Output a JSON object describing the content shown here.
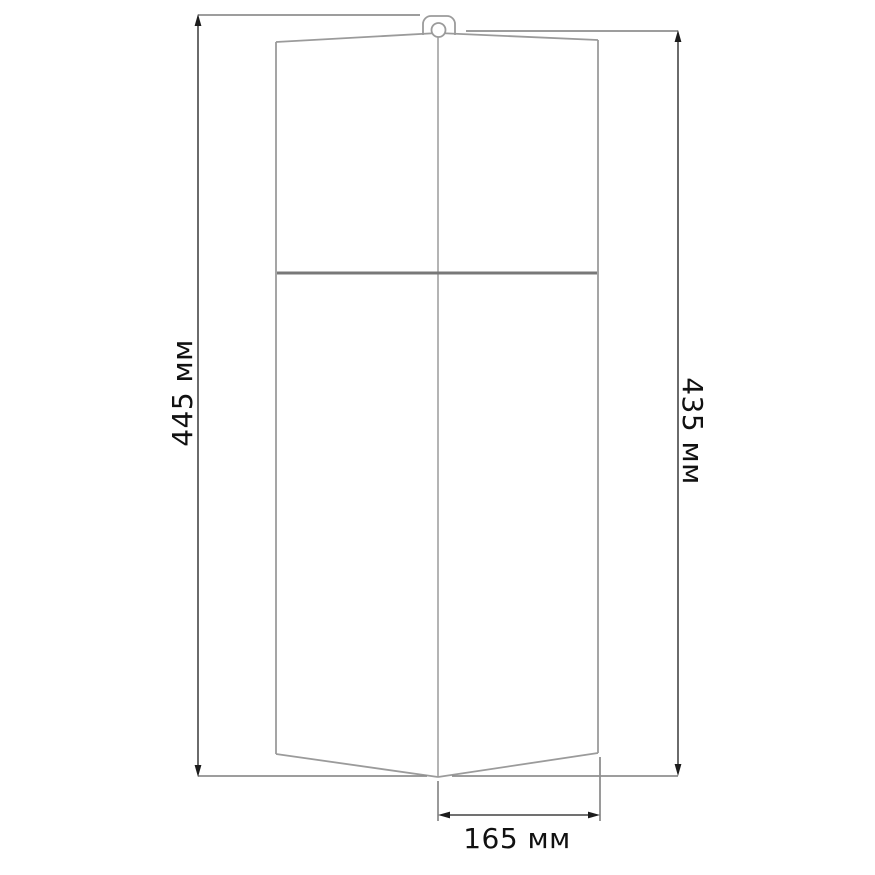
{
  "drawing": {
    "type": "technical-dimension-diagram",
    "subject": "hanging cover / case outline, front view with hanger loop",
    "dimensions": {
      "height_left": {
        "value": 445,
        "unit": "мм",
        "label": "445 мм"
      },
      "height_right": {
        "value": 435,
        "unit": "мм",
        "label": "435 мм"
      },
      "width_bottom": {
        "value": 165,
        "unit": "мм",
        "label": "165 мм"
      }
    },
    "colors": {
      "background": "#ffffff",
      "object_outline": "#9b9b9b",
      "fold_line": "#787878",
      "extension_line": "#8f8f8f",
      "dimension_line": "#1c1c1c",
      "label_text": "#111111"
    }
  }
}
